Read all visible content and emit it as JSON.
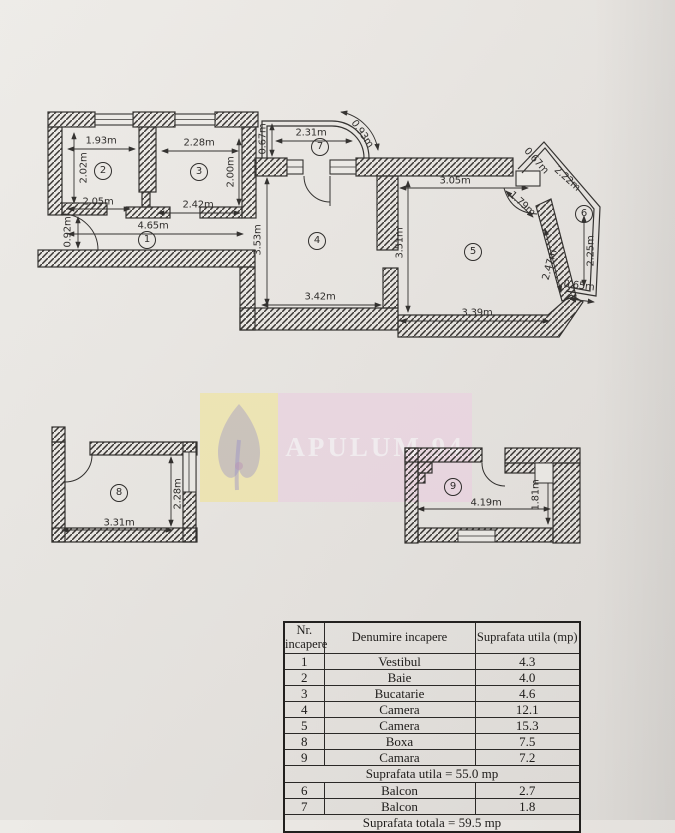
{
  "page": {
    "background": "#e9e6e2"
  },
  "watermark": {
    "text": "APULUM 94",
    "yellow_bg": "#f2e8ae",
    "pink_bg": "#ecd7e3",
    "text_color": "#f7f1f5",
    "logo_color": "#8d85c5"
  },
  "plan": {
    "line_color": "#2f2d2b",
    "dim_labels": [
      {
        "t": "1.93m",
        "x": 101,
        "y": 141,
        "r": 0
      },
      {
        "t": "2.02m",
        "x": 84,
        "y": 168,
        "r": -90
      },
      {
        "t": "2.05m",
        "x": 98,
        "y": 202,
        "r": 0
      },
      {
        "t": "2.28m",
        "x": 199,
        "y": 143,
        "r": 0
      },
      {
        "t": "2.00m",
        "x": 231,
        "y": 172,
        "r": -90
      },
      {
        "t": "2.42m",
        "x": 198,
        "y": 205,
        "r": 0
      },
      {
        "t": "0.67m",
        "x": 263,
        "y": 139,
        "r": -90
      },
      {
        "t": "2.31m",
        "x": 311,
        "y": 133,
        "r": 0
      },
      {
        "t": "0.93m",
        "x": 362,
        "y": 134,
        "r": 55
      },
      {
        "t": "4.65m",
        "x": 153,
        "y": 226,
        "r": 0
      },
      {
        "t": "0.92m",
        "x": 68,
        "y": 232,
        "r": -90
      },
      {
        "t": "3.53m",
        "x": 258,
        "y": 240,
        "r": -90
      },
      {
        "t": "3.42m",
        "x": 320,
        "y": 297,
        "r": 0
      },
      {
        "t": "3.51m",
        "x": 400,
        "y": 243,
        "r": -90
      },
      {
        "t": "3.05m",
        "x": 455,
        "y": 181,
        "r": 0
      },
      {
        "t": "3.39m",
        "x": 477,
        "y": 313,
        "r": 0
      },
      {
        "t": "1.79m",
        "x": 522,
        "y": 204,
        "r": 42
      },
      {
        "t": "0.67m",
        "x": 536,
        "y": 161,
        "r": 48
      },
      {
        "t": "2.22m",
        "x": 567,
        "y": 179,
        "r": 42
      },
      {
        "t": "2.25m",
        "x": 591,
        "y": 251,
        "r": -90
      },
      {
        "t": "0.65m",
        "x": 579,
        "y": 286,
        "r": 7
      },
      {
        "t": "2.47m",
        "x": 550,
        "y": 265,
        "r": -75
      },
      {
        "t": "3.31m",
        "x": 119,
        "y": 523,
        "r": 0
      },
      {
        "t": "2.28m",
        "x": 178,
        "y": 494,
        "r": -90
      },
      {
        "t": "4.19m",
        "x": 486,
        "y": 503,
        "r": 0
      },
      {
        "t": "1.81m",
        "x": 536,
        "y": 495,
        "r": -90
      }
    ],
    "rooms": [
      {
        "n": "1",
        "x": 147,
        "y": 240
      },
      {
        "n": "2",
        "x": 103,
        "y": 171
      },
      {
        "n": "3",
        "x": 199,
        "y": 172
      },
      {
        "n": "4",
        "x": 317,
        "y": 241
      },
      {
        "n": "5",
        "x": 473,
        "y": 252
      },
      {
        "n": "6",
        "x": 584,
        "y": 214
      },
      {
        "n": "7",
        "x": 320,
        "y": 147
      },
      {
        "n": "8",
        "x": 119,
        "y": 493
      },
      {
        "n": "9",
        "x": 453,
        "y": 487
      }
    ]
  },
  "table": {
    "headers": [
      "Nr. incapere",
      "Denumire incapere",
      "Suprafata utila (mp)"
    ],
    "rows": [
      {
        "nr": "1",
        "name": "Vestibul",
        "area": "4.3"
      },
      {
        "nr": "2",
        "name": "Baie",
        "area": "4.0"
      },
      {
        "nr": "3",
        "name": "Bucatarie",
        "area": "4.6"
      },
      {
        "nr": "4",
        "name": "Camera",
        "area": "12.1"
      },
      {
        "nr": "5",
        "name": "Camera",
        "area": "15.3"
      },
      {
        "nr": "8",
        "name": "Boxa",
        "area": "7.5"
      },
      {
        "nr": "9",
        "name": "Camara",
        "area": "7.2"
      }
    ],
    "subtotal": "Suprafata utila =  55.0 mp",
    "balcony_rows": [
      {
        "nr": "6",
        "name": "Balcon",
        "area": "2.7"
      },
      {
        "nr": "7",
        "name": "Balcon",
        "area": "1.8"
      }
    ],
    "total": "Suprafata totala =  59.5 mp"
  }
}
